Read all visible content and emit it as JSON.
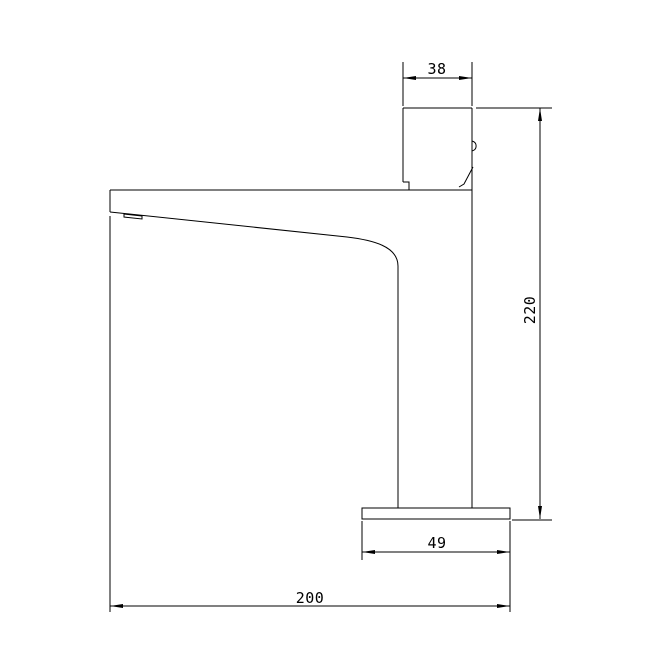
{
  "page": {
    "background_color": "#ffffff"
  },
  "drawing": {
    "kind": "technical-dimension-drawing",
    "subject": "basin-faucet-side-elevation",
    "line_color": "#000000",
    "dimension_labels": {
      "top_width": "38",
      "overall_height": "220",
      "base_width": "49",
      "overall_length": "200"
    }
  }
}
